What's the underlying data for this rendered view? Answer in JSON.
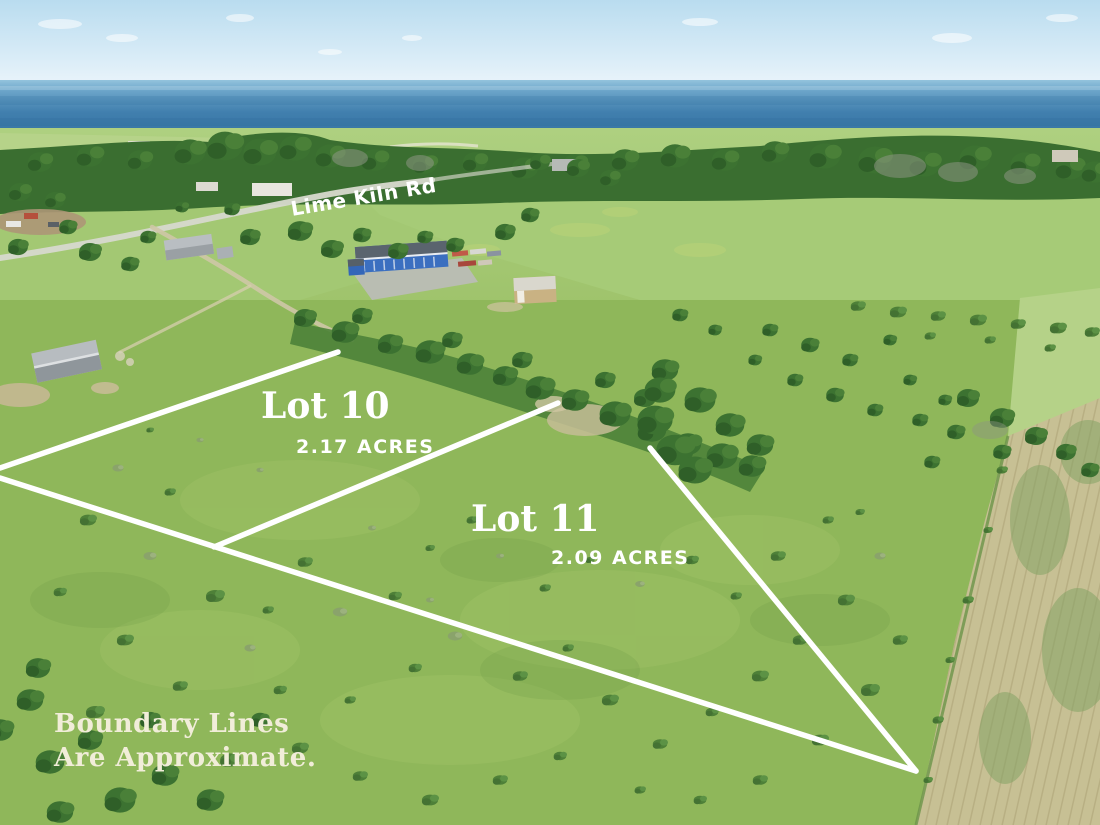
{
  "image": {
    "type": "aerial-lot-photo",
    "road_label": "Lime Kiln Rd",
    "lots": [
      {
        "name": "Lot 10",
        "acreage": "2.17 ACRES"
      },
      {
        "name": "Lot 11",
        "acreage": "2.09 ACRES"
      }
    ],
    "disclaimer": {
      "line1": "Boundary Lines",
      "line2": "Are Approximate."
    }
  },
  "colors": {
    "boundaryLine": "#ffffff",
    "labelText": "#ffffff",
    "disclaimerText": "#f1edd9",
    "skyTop": "#b9dcef",
    "skyHorizon": "#e8f3fa",
    "waterHorizon": "#93c3dd",
    "waterDeep": "#31719f",
    "waterNear": "#3a7ba8",
    "fieldLight": "#a6cb77",
    "pasture": "#8fb75a",
    "treeDark": "#3c7231",
    "tilledField": "#c7c094",
    "buildingBlue": "#3b6fc0",
    "shedTan": "#c9b283"
  }
}
